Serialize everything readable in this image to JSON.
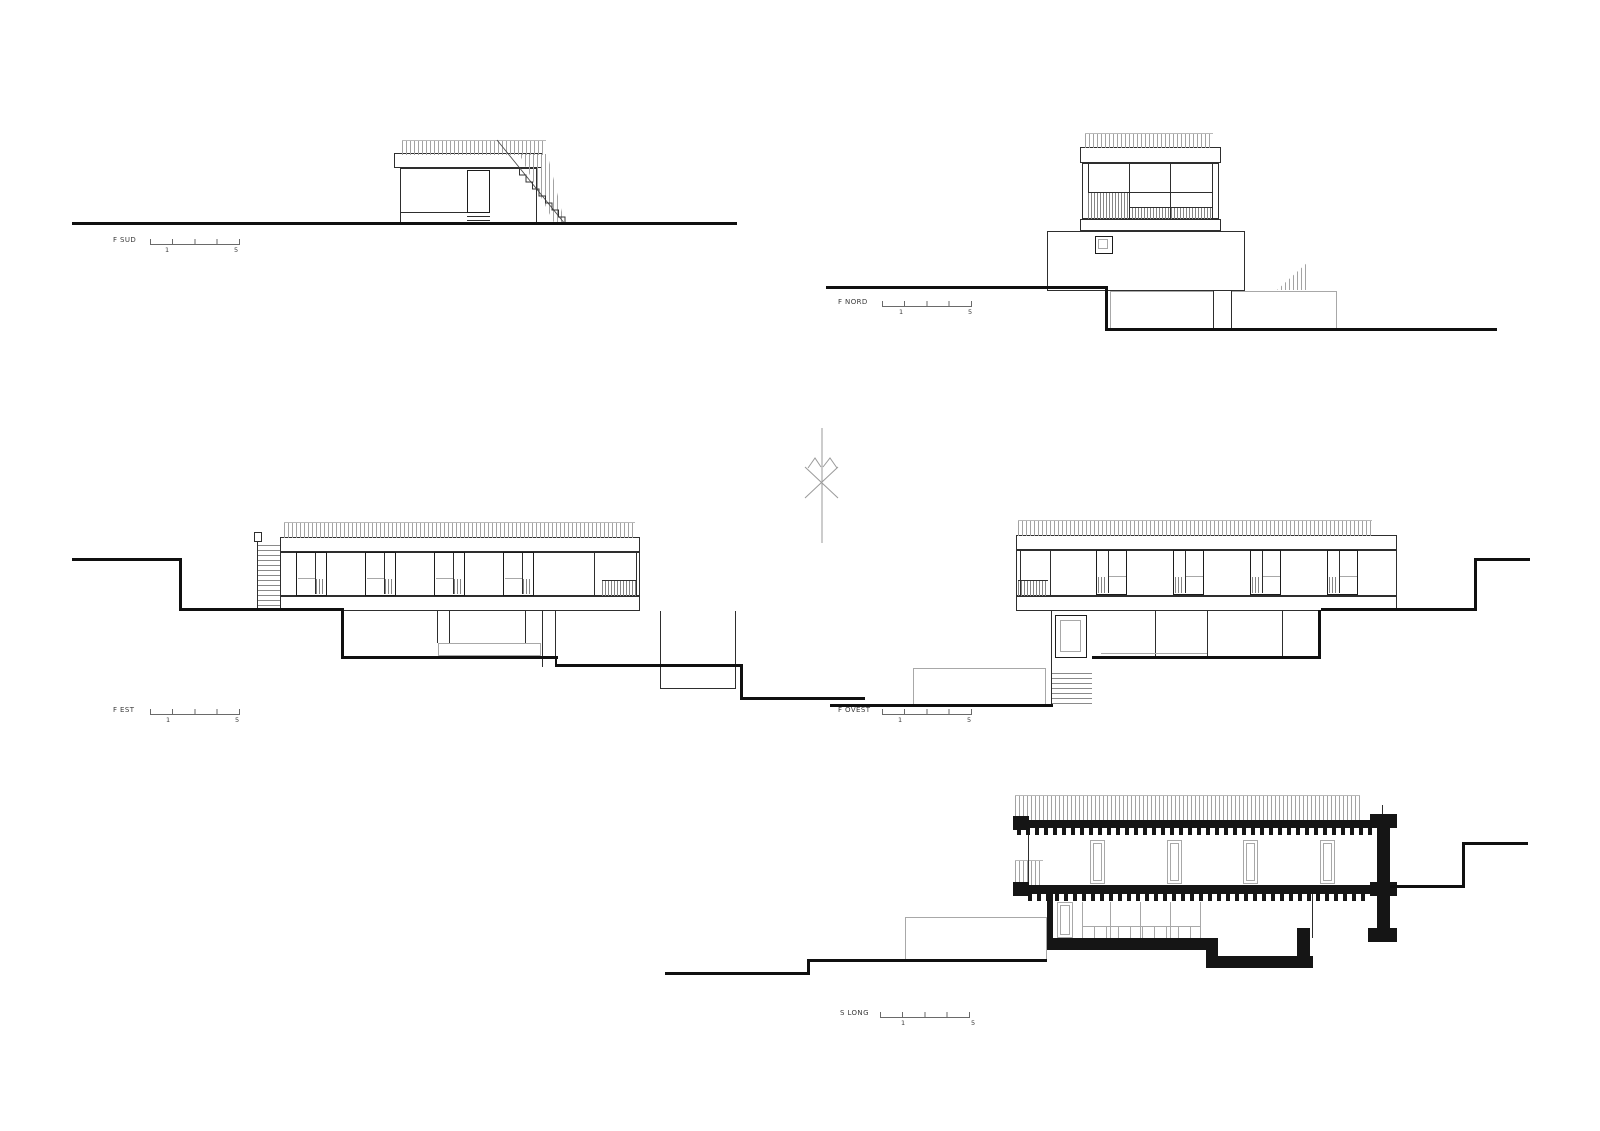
{
  "sheet": {
    "background": "#ffffff",
    "line_color": "#2e2e2e",
    "terrain_color": "#101010",
    "section_fill": "#151515",
    "hatch_color": "#a3a3a3"
  },
  "drawings": {
    "f_sud": {
      "label": "F SUD",
      "scale": {
        "one": "1",
        "five": "5"
      }
    },
    "f_nord": {
      "label": "F NORD",
      "scale": {
        "one": "1",
        "five": "5"
      }
    },
    "f_est": {
      "label": "F EST",
      "scale": {
        "one": "1",
        "five": "5"
      }
    },
    "f_ovest": {
      "label": "F OVEST",
      "scale": {
        "one": "1",
        "five": "5"
      }
    },
    "s_long": {
      "label": "S LONG",
      "scale": {
        "one": "1",
        "five": "5"
      }
    }
  }
}
